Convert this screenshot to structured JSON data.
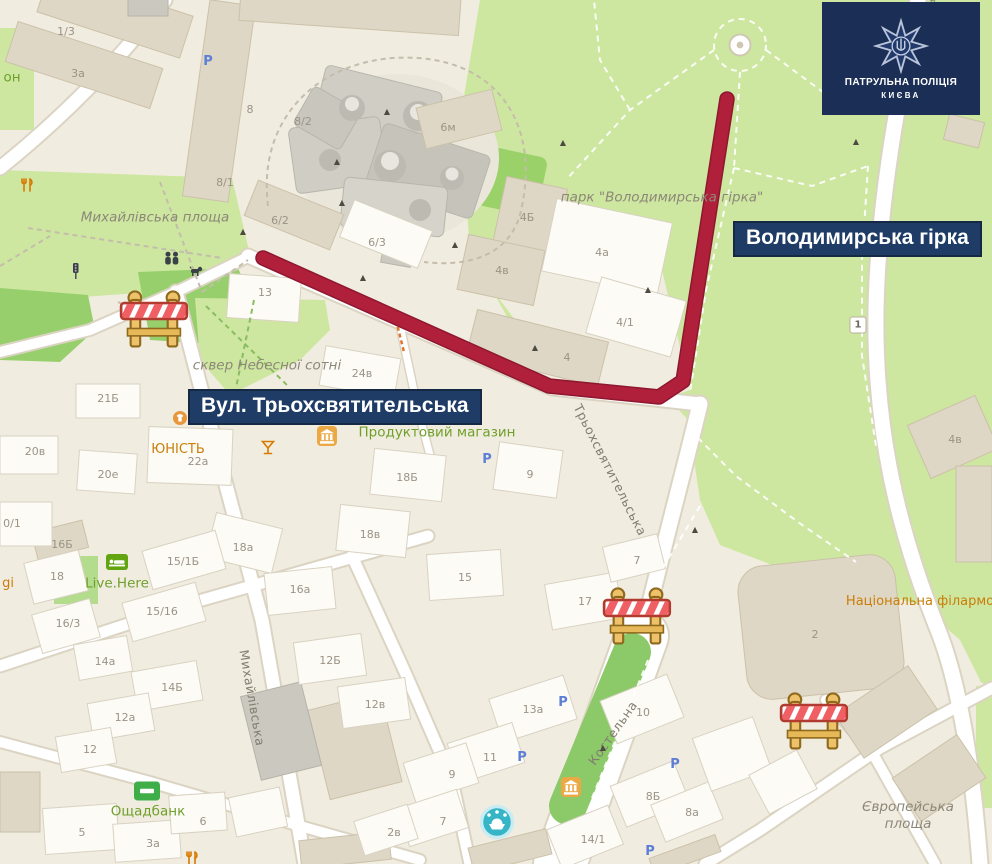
{
  "banners": {
    "park_label": "Володимирська гірка",
    "street_label": "Вул. Трьохсвятительська"
  },
  "logo": {
    "org": "ПАТРУЛЬНА ПОЛІЦІЯ",
    "city": "КИЄВА"
  },
  "colors": {
    "banner_bg": "#1e3c66",
    "logo_bg": "#1b2e55",
    "route_red": "#b0203a",
    "park_green": "#cde7a0",
    "poi_green": "#6fa02b",
    "poi_orange": "#ca7d08"
  },
  "labels": {
    "places": [
      {
        "t": "Михайлівська площа",
        "x": 155,
        "y": 218
      },
      {
        "t": "сквер Небесної сотні",
        "x": 267,
        "y": 366
      },
      {
        "t": "парк \"Володимирська гірка\"",
        "x": 662,
        "y": 198
      },
      {
        "t": "Європейська\nплоща",
        "x": 908,
        "y": 816
      }
    ],
    "streets": [
      {
        "t": "Михайлівська",
        "x": 252,
        "y": 698,
        "r": 80
      },
      {
        "t": "Костельна",
        "x": 613,
        "y": 733,
        "r": -55
      },
      {
        "t": "Трьохсвятительська",
        "x": 610,
        "y": 470,
        "r": 63
      },
      {
        "t": "ський узвіз",
        "x": 941,
        "y": 30,
        "r": 78
      }
    ],
    "poi_green": [
      {
        "t": "Продуктовий магазин",
        "x": 437,
        "y": 433
      },
      {
        "t": "Live.Here",
        "x": 117,
        "y": 584
      },
      {
        "t": "Ощадбанк",
        "x": 148,
        "y": 812
      },
      {
        "t": "он",
        "x": 12,
        "y": 78
      }
    ],
    "poi_orange": [
      {
        "t": "ЮНІСТЬ",
        "x": 178,
        "y": 450
      },
      {
        "t": "Національна філармонія",
        "x": 930,
        "y": 602
      },
      {
        "t": "gi",
        "x": 8,
        "y": 584
      }
    ],
    "building_numbers": [
      {
        "t": "1/3",
        "x": 66,
        "y": 32
      },
      {
        "t": "3а",
        "x": 78,
        "y": 74
      },
      {
        "t": "8",
        "x": 250,
        "y": 110
      },
      {
        "t": "8/2",
        "x": 303,
        "y": 122
      },
      {
        "t": "6м",
        "x": 448,
        "y": 128
      },
      {
        "t": "8/1",
        "x": 225,
        "y": 183
      },
      {
        "t": "6/2",
        "x": 280,
        "y": 221
      },
      {
        "t": "6/3",
        "x": 377,
        "y": 243
      },
      {
        "t": "4Б",
        "x": 527,
        "y": 218
      },
      {
        "t": "4а",
        "x": 602,
        "y": 253
      },
      {
        "t": "4в",
        "x": 502,
        "y": 271
      },
      {
        "t": "4/1",
        "x": 625,
        "y": 323
      },
      {
        "t": "13",
        "x": 265,
        "y": 293
      },
      {
        "t": "4",
        "x": 567,
        "y": 358
      },
      {
        "t": "24в",
        "x": 362,
        "y": 374
      },
      {
        "t": "21Б",
        "x": 108,
        "y": 399
      },
      {
        "t": "20в",
        "x": 35,
        "y": 452
      },
      {
        "t": "20е",
        "x": 108,
        "y": 475
      },
      {
        "t": "22а",
        "x": 198,
        "y": 462
      },
      {
        "t": "0/1",
        "x": 12,
        "y": 524
      },
      {
        "t": "18Б",
        "x": 407,
        "y": 478
      },
      {
        "t": "9",
        "x": 530,
        "y": 475
      },
      {
        "t": "18в",
        "x": 370,
        "y": 535
      },
      {
        "t": "18а",
        "x": 243,
        "y": 548
      },
      {
        "t": "16Б",
        "x": 62,
        "y": 545
      },
      {
        "t": "18",
        "x": 57,
        "y": 577
      },
      {
        "t": "15/1Б",
        "x": 183,
        "y": 562
      },
      {
        "t": "15/16",
        "x": 162,
        "y": 612
      },
      {
        "t": "16а",
        "x": 300,
        "y": 590
      },
      {
        "t": "16/3",
        "x": 68,
        "y": 624
      },
      {
        "t": "15",
        "x": 465,
        "y": 578
      },
      {
        "t": "17",
        "x": 585,
        "y": 602
      },
      {
        "t": "7",
        "x": 637,
        "y": 561
      },
      {
        "t": "12Б",
        "x": 330,
        "y": 661
      },
      {
        "t": "12в",
        "x": 375,
        "y": 705
      },
      {
        "t": "14Б",
        "x": 172,
        "y": 688
      },
      {
        "t": "14а",
        "x": 105,
        "y": 662
      },
      {
        "t": "12а",
        "x": 125,
        "y": 718
      },
      {
        "t": "12",
        "x": 90,
        "y": 750
      },
      {
        "t": "13а",
        "x": 533,
        "y": 710
      },
      {
        "t": "10",
        "x": 643,
        "y": 713
      },
      {
        "t": "11",
        "x": 490,
        "y": 758
      },
      {
        "t": "9",
        "x": 452,
        "y": 775
      },
      {
        "t": "7",
        "x": 443,
        "y": 822
      },
      {
        "t": "2в",
        "x": 394,
        "y": 833
      },
      {
        "t": "8Б",
        "x": 653,
        "y": 797
      },
      {
        "t": "8а",
        "x": 692,
        "y": 813
      },
      {
        "t": "14/1",
        "x": 593,
        "y": 840
      },
      {
        "t": "5",
        "x": 82,
        "y": 833
      },
      {
        "t": "3а",
        "x": 153,
        "y": 844
      },
      {
        "t": "6",
        "x": 203,
        "y": 822
      },
      {
        "t": "2",
        "x": 815,
        "y": 635
      },
      {
        "t": "4в",
        "x": 955,
        "y": 440
      }
    ],
    "road_shield": {
      "t": "1",
      "x": 858,
      "y": 325
    }
  },
  "icons": {
    "barriers": [
      {
        "x": 155,
        "y": 320
      },
      {
        "x": 638,
        "y": 617
      },
      {
        "x": 815,
        "y": 722
      }
    ],
    "parking": [
      {
        "x": 208,
        "y": 62
      },
      {
        "x": 487,
        "y": 460
      },
      {
        "x": 563,
        "y": 703
      },
      {
        "x": 522,
        "y": 758
      },
      {
        "x": 675,
        "y": 765
      },
      {
        "x": 650,
        "y": 852
      }
    ],
    "monuments": [
      {
        "x": 387,
        "y": 112
      },
      {
        "x": 337,
        "y": 162
      },
      {
        "x": 342,
        "y": 203
      },
      {
        "x": 243,
        "y": 232
      },
      {
        "x": 363,
        "y": 278
      },
      {
        "x": 455,
        "y": 245
      },
      {
        "x": 563,
        "y": 143
      },
      {
        "x": 535,
        "y": 348
      },
      {
        "x": 695,
        "y": 530
      },
      {
        "x": 603,
        "y": 748
      },
      {
        "x": 856,
        "y": 142
      },
      {
        "x": 648,
        "y": 290
      }
    ],
    "banks": [
      {
        "x": 327,
        "y": 436
      },
      {
        "x": 571,
        "y": 787
      }
    ],
    "restaurants": [
      {
        "x": 27,
        "y": 185
      },
      {
        "x": 192,
        "y": 858
      }
    ],
    "cocktails": [
      {
        "x": 268,
        "y": 447
      }
    ],
    "hotels": [
      {
        "x": 117,
        "y": 562
      }
    ],
    "atms": [
      {
        "x": 147,
        "y": 791
      }
    ],
    "fountains": [
      {
        "x": 497,
        "y": 822
      }
    ],
    "shops": [
      {
        "x": 180,
        "y": 418
      }
    ],
    "people": [
      {
        "x": 172,
        "y": 258
      }
    ],
    "dogs": [
      {
        "x": 196,
        "y": 271
      }
    ],
    "traffic_lights": [
      {
        "x": 76,
        "y": 271
      }
    ],
    "plaza": [
      {
        "x": 740,
        "y": 45
      }
    ]
  }
}
